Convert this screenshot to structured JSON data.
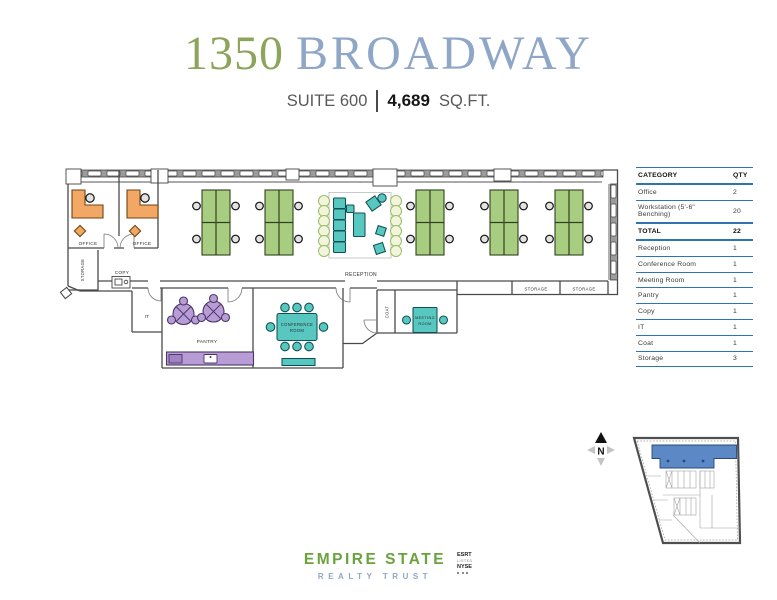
{
  "title": {
    "number": "1350",
    "name": "BROADWAY"
  },
  "subtitle": {
    "suite": "SUITE 600",
    "area": "4,689",
    "unit": "SQ.FT."
  },
  "summary_table": {
    "headers": {
      "category": "CATEGORY",
      "qty": "QTY"
    },
    "rows": [
      {
        "category": "Office",
        "qty": "2"
      },
      {
        "category": "Workstation (5'-6\" Benching)",
        "qty": "20"
      },
      {
        "category": "TOTAL",
        "qty": "22"
      },
      {
        "category": "Reception",
        "qty": "1"
      },
      {
        "category": "Conference Room",
        "qty": "1"
      },
      {
        "category": "Meeting Room",
        "qty": "1"
      },
      {
        "category": "Pantry",
        "qty": "1"
      },
      {
        "category": "Copy",
        "qty": "1"
      },
      {
        "category": "IT",
        "qty": "1"
      },
      {
        "category": "Coat",
        "qty": "1"
      },
      {
        "category": "Storage",
        "qty": "3"
      }
    ]
  },
  "plan": {
    "labels": {
      "office": "OFFICE",
      "storage": "STORAGE",
      "copy": "COPY",
      "reception": "RECEPTION",
      "it": "IT",
      "pantry": "PANTRY",
      "conference_line1": "CONFERENCE",
      "conference_line2": "ROOM",
      "coat": "COAT",
      "meeting_line1": "MEETING",
      "meeting_line2": "ROOM"
    }
  },
  "key_plan": {
    "north": "N"
  },
  "footer": {
    "brand_line1": "EMPIRE STATE",
    "brand_line2": "REALTY TRUST",
    "badge_line1": "ESRT",
    "badge_line2": "LISTED",
    "badge_line3": "NYSE"
  },
  "colors": {
    "title_green": "#8ca55a",
    "title_blue": "#8fa7c7",
    "table_rule_blue": "#2e74b5",
    "desk_green": "#a9cd80",
    "desk_orange": "#f2a765",
    "furniture_teal": "#57c7c0",
    "furniture_purple": "#b89cd6",
    "plant_green": "#9cba68",
    "suite_highlight_blue": "#5c88c6",
    "brand_green": "#69a33d",
    "brand_blue": "#8fa7c7"
  }
}
